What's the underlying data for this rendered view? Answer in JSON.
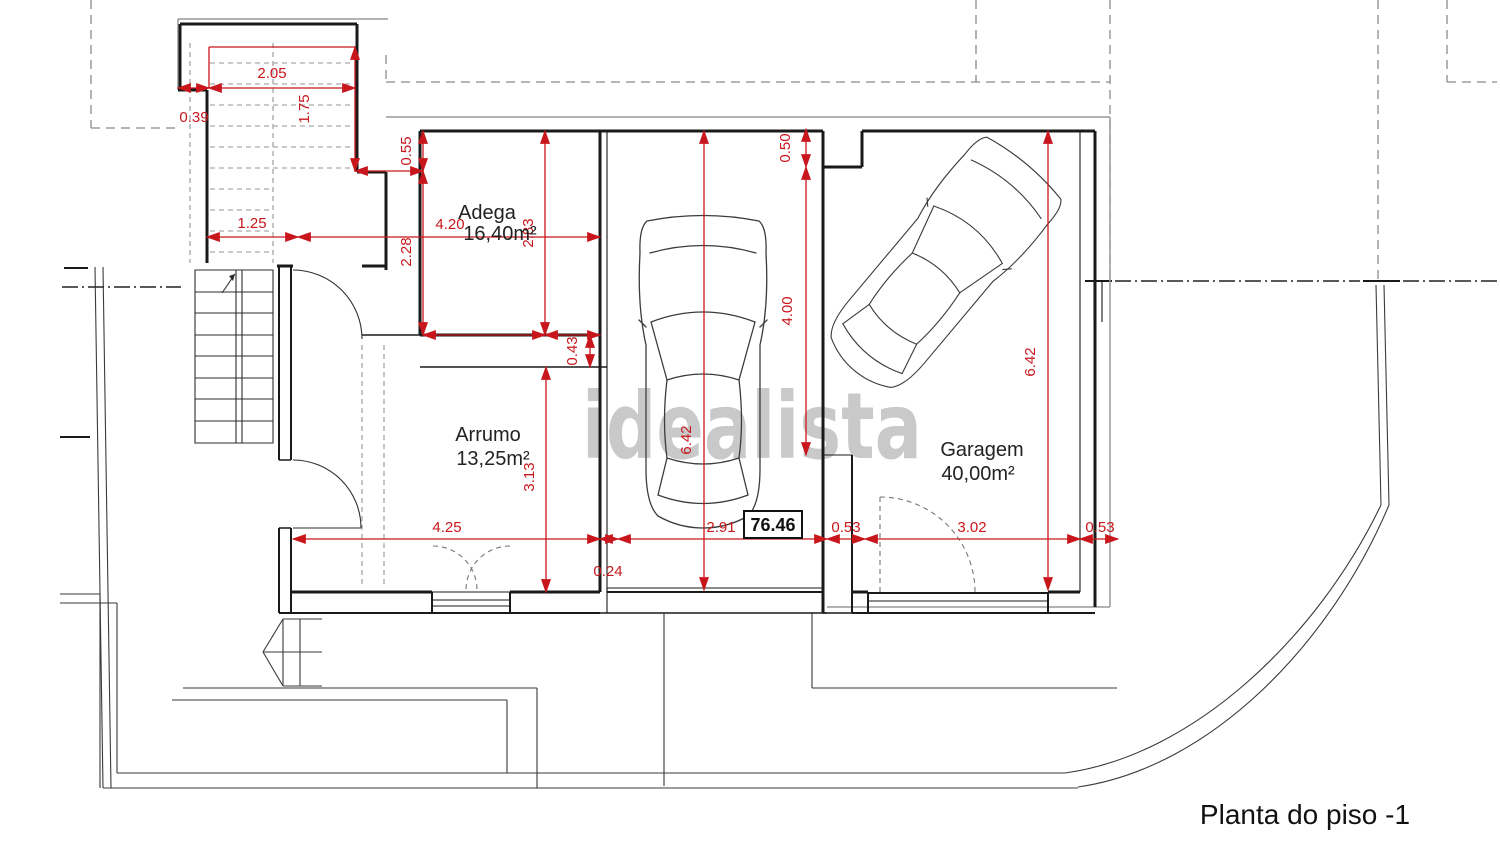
{
  "plan": {
    "title": "Planta do piso -1",
    "watermark": "idealista",
    "level_marker": "76.46",
    "rooms": {
      "adega": {
        "name": "Adega",
        "area": "16,40m²"
      },
      "arrumo": {
        "name": "Arrumo",
        "area": "13,25m²"
      },
      "garagem": {
        "name": "Garagem",
        "area": "40,00m²"
      }
    },
    "dims": {
      "d039": "0.39",
      "d205": "2.05",
      "d175": "1.75",
      "d055": "0.55",
      "d125": "1.25",
      "d420": "4.20",
      "d228": "2.28",
      "d283": "2.83",
      "d043": "0.43",
      "d642_bay": "6.42",
      "d050": "0.50",
      "d400": "4.00",
      "d642_gar": "6.42",
      "d313": "3.13",
      "d425": "4.25",
      "d024": "0.24",
      "d291": "2.91",
      "d053_left": "0.53",
      "d302": "3.02",
      "d053_right": "0.53"
    },
    "colors": {
      "dimension_red": "#c8171c",
      "wall_black": "#1a1a1a",
      "watermark_gray": "#c9c9c9"
    }
  }
}
